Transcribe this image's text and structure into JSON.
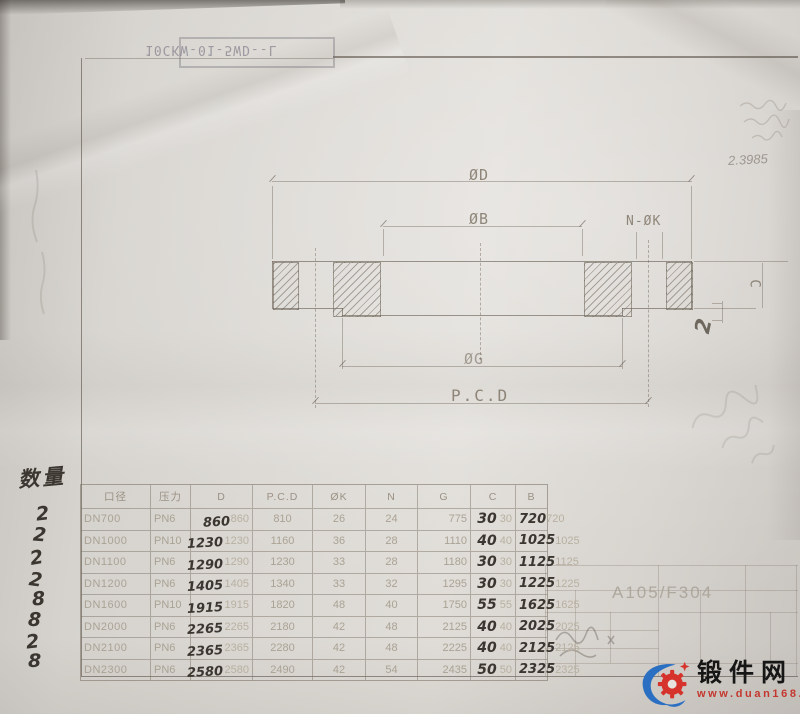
{
  "stamp": {
    "text": "10CKW-01-5WD--L"
  },
  "drawing": {
    "labels": {
      "outer_diameter": "ØD",
      "bore": "ØB",
      "bolt_holes": "N-ØK",
      "groove": "ØG",
      "bolt_circle": "P.C.D",
      "thickness": "C"
    }
  },
  "annotations": {
    "quantity_label": "数量",
    "quantities": [
      "2",
      "2",
      "2",
      "2",
      "8",
      "8",
      "2",
      "8"
    ],
    "corner_note": "2.3985",
    "thickness_note": "2"
  },
  "table": {
    "headers": [
      "口径",
      "压力",
      "D",
      "P.C.D",
      "ØK",
      "N",
      "G",
      "C",
      "B"
    ],
    "rows": [
      {
        "dn": "DN700",
        "pn": "PN6",
        "d_hw": "860",
        "d": "860",
        "pcd": "810",
        "k": "26",
        "n": "24",
        "g": "775",
        "c_hw": "30",
        "c": "30",
        "b_hw": "720",
        "b": "720"
      },
      {
        "dn": "DN1000",
        "pn": "PN10",
        "d_hw": "1230",
        "d": "1230",
        "pcd": "1160",
        "k": "36",
        "n": "28",
        "g": "1110",
        "c_hw": "40",
        "c": "40",
        "b_hw": "1025",
        "b": "1025"
      },
      {
        "dn": "DN1100",
        "pn": "PN6",
        "d_hw": "1290",
        "d": "1290",
        "pcd": "1230",
        "k": "33",
        "n": "28",
        "g": "1180",
        "c_hw": "30",
        "c": "30",
        "b_hw": "1125",
        "b": "1125"
      },
      {
        "dn": "DN1200",
        "pn": "PN6",
        "d_hw": "1405",
        "d": "1405",
        "pcd": "1340",
        "k": "33",
        "n": "32",
        "g": "1295",
        "c_hw": "30",
        "c": "30",
        "b_hw": "1225",
        "b": "1225"
      },
      {
        "dn": "DN1600",
        "pn": "PN10",
        "d_hw": "1915",
        "d": "1915",
        "pcd": "1820",
        "k": "48",
        "n": "40",
        "g": "1750",
        "c_hw": "55",
        "c": "55",
        "b_hw": "1625",
        "b": "1625"
      },
      {
        "dn": "DN2000",
        "pn": "PN6",
        "d_hw": "2265",
        "d": "2265",
        "pcd": "2180",
        "k": "42",
        "n": "48",
        "g": "2125",
        "c_hw": "40",
        "c": "40",
        "b_hw": "2025",
        "b": "2025"
      },
      {
        "dn": "DN2100",
        "pn": "PN6",
        "d_hw": "2365",
        "d": "2365",
        "pcd": "2280",
        "k": "42",
        "n": "48",
        "g": "2225",
        "c_hw": "40",
        "c": "40",
        "b_hw": "2125",
        "b": "2125"
      },
      {
        "dn": "DN2300",
        "pn": "PN6",
        "d_hw": "2580",
        "d": "2580",
        "pcd": "2490",
        "k": "42",
        "n": "54",
        "g": "2435",
        "c_hw": "50",
        "c": "50",
        "b_hw": "2325",
        "b": "2325"
      }
    ]
  },
  "title_block": {
    "material": "A105/F304"
  },
  "watermark": {
    "site_name": "锻件网",
    "site_url": "www.duan168.com",
    "brand_blue": "#2b6fc2",
    "brand_red": "#d6332c"
  }
}
